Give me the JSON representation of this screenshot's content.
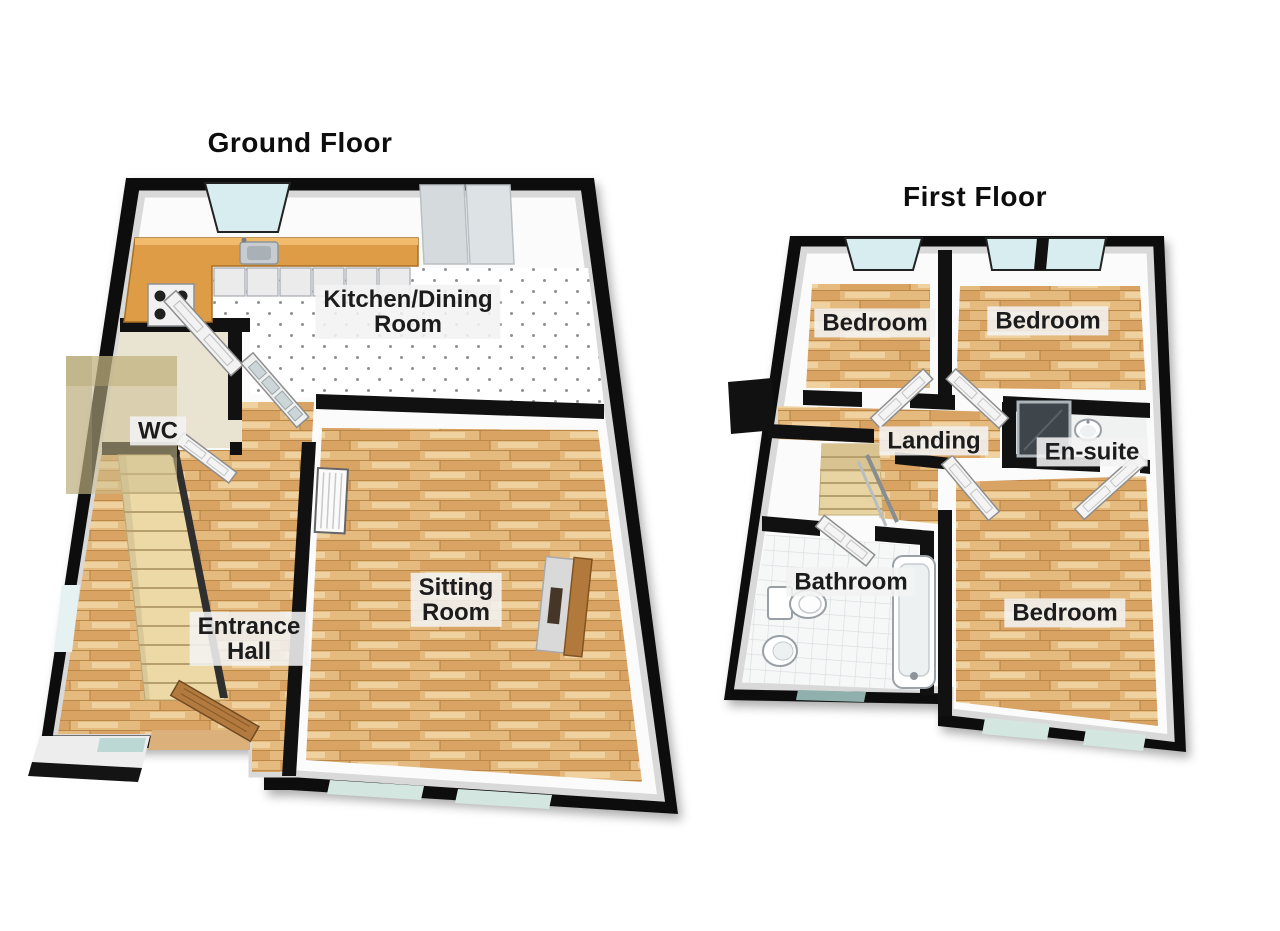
{
  "page": {
    "background": "#ffffff",
    "type": "3d-floor-plan"
  },
  "ground_floor": {
    "title": "Ground Floor",
    "rooms": {
      "kitchen": {
        "line1": "Kitchen/Dining",
        "line2": "Room"
      },
      "wc": {
        "line1": "WC"
      },
      "entrance_hall": {
        "line1": "Entrance",
        "line2": "Hall"
      },
      "sitting_room": {
        "line1": "Sitting",
        "line2": "Room"
      }
    }
  },
  "first_floor": {
    "title": "First Floor",
    "rooms": {
      "bedroom_top_left": {
        "line1": "Bedroom"
      },
      "bedroom_top_right": {
        "line1": "Bedroom"
      },
      "landing": {
        "line1": "Landing"
      },
      "en_suite": {
        "line1": "En-suite"
      },
      "bathroom": {
        "line1": "Bathroom"
      },
      "bedroom_bottom": {
        "line1": "Bedroom"
      }
    }
  },
  "colors": {
    "wall": "#111111",
    "wood_floor": "#e3b678",
    "kitchen_counter": "#dd9c45",
    "stairs": "#ecd9a6",
    "window_glass": "#d8edef",
    "label_background": "rgba(243,243,243,0.88)",
    "label_text": "#1c1c1c"
  }
}
